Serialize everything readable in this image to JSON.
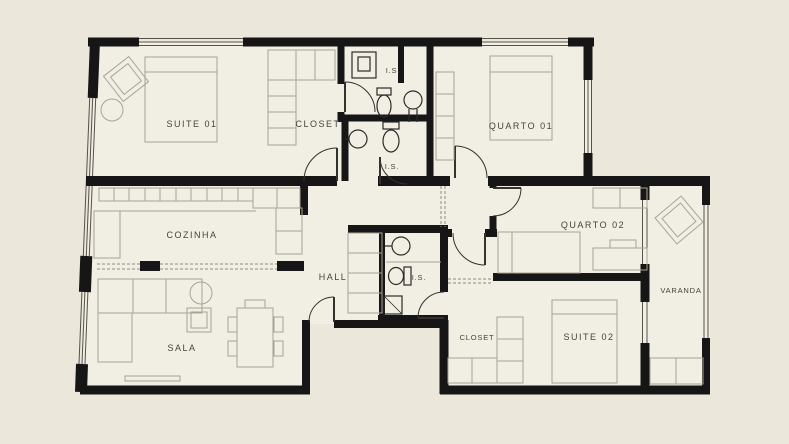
{
  "plan": {
    "name": "apartment-floor-plan",
    "colors": {
      "background": "#EBE7DA",
      "floor": "#F1EEE3",
      "wall": "#161616",
      "furniture": "#A8A494",
      "fixture": "#2B2B28",
      "text": "#45443C"
    },
    "rooms": [
      {
        "id": "suite-01",
        "label": "SUITE 01"
      },
      {
        "id": "closet-1",
        "label": "CLOSET"
      },
      {
        "id": "is-1",
        "label": "I.S."
      },
      {
        "id": "quarto-01",
        "label": "QUARTO 01"
      },
      {
        "id": "is-2",
        "label": "I.S."
      },
      {
        "id": "cozinha",
        "label": "COZINHA"
      },
      {
        "id": "hall",
        "label": "HALL"
      },
      {
        "id": "is-3",
        "label": "I.S."
      },
      {
        "id": "quarto-02",
        "label": "QUARTO 02"
      },
      {
        "id": "varanda",
        "label": "VARANDA"
      },
      {
        "id": "sala",
        "label": "SALA"
      },
      {
        "id": "closet-2",
        "label": "CLOSET"
      },
      {
        "id": "suite-02",
        "label": "SUITE 02"
      }
    ]
  }
}
